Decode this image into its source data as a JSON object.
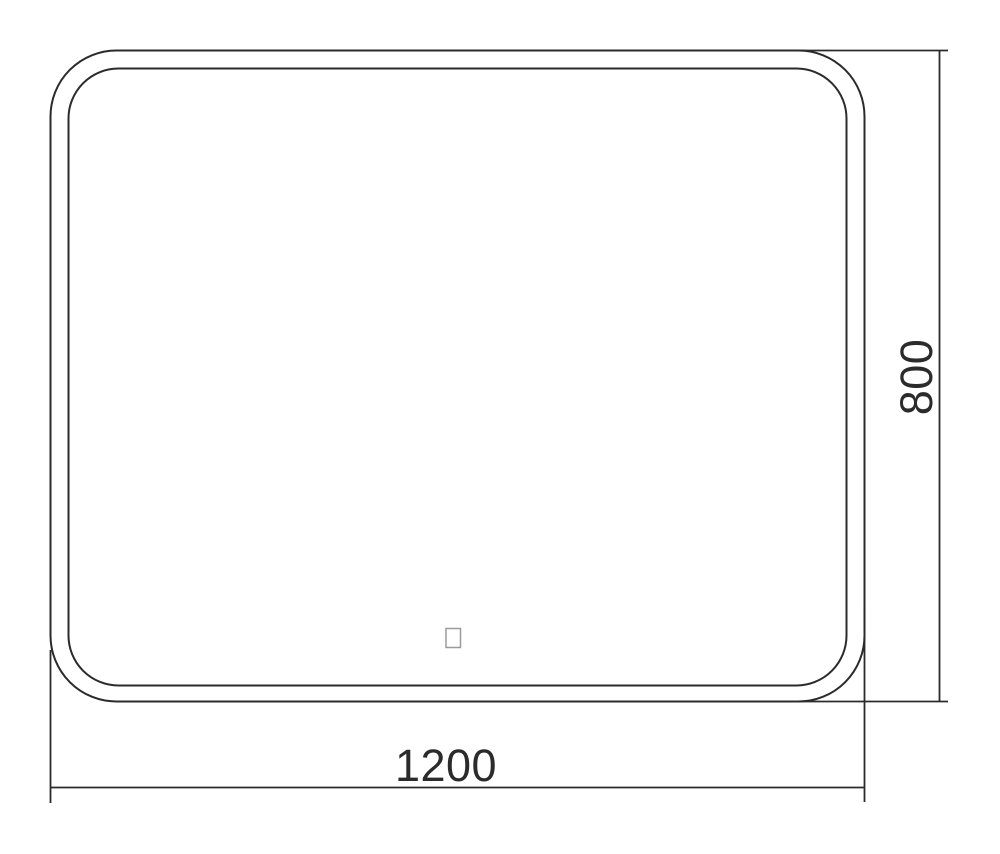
{
  "drawing": {
    "kind": "mirror-front-view-dimension-drawing",
    "width_dimension": "1200",
    "height_dimension": "800"
  },
  "icons": {
    "touch_sensor": "touch-sensor-square"
  },
  "colors": {
    "line": "#2b2b2b",
    "text": "#2b2b2b",
    "sensor_border": "#9b9b9b",
    "background": "#ffffff"
  }
}
